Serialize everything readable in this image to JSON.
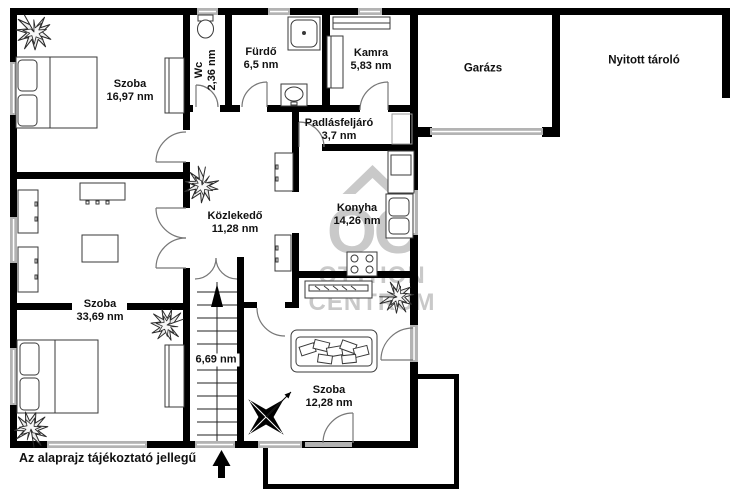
{
  "plan": {
    "disclaimer": "Az alaprajz tájékoztató jellegű",
    "watermark": {
      "monogram": "OC",
      "line1": "OTTHON",
      "line2": "CENTRUM"
    },
    "rooms": {
      "bedroom_top": {
        "name": "Szoba",
        "area": "16,97 nm"
      },
      "wc": {
        "name": "Wc",
        "area": "2,36 nm"
      },
      "bathroom": {
        "name": "Fürdő",
        "area": "6,5 nm"
      },
      "pantry": {
        "name": "Kamra",
        "area": "5,83 nm"
      },
      "garage": {
        "name": "Garázs"
      },
      "open_storage": {
        "name": "Nyitott tároló"
      },
      "attic_access": {
        "name": "Padlásfeljáró",
        "area": "3,7 nm"
      },
      "hallway": {
        "name": "Közlekedő",
        "area": "11,28 nm"
      },
      "kitchen": {
        "name": "Konyha",
        "area": "14,26 nm"
      },
      "bedroom_left": {
        "name": "Szoba",
        "area": "33,69 nm"
      },
      "staircase": {
        "area": "6,69 nm"
      },
      "bedroom_bottom": {
        "name": "Szoba",
        "area": "12,28 nm"
      }
    },
    "colors": {
      "wall": "#000000",
      "window": "#b3b3b3",
      "watermark": "#c9c9c9",
      "text": "#111111"
    }
  }
}
